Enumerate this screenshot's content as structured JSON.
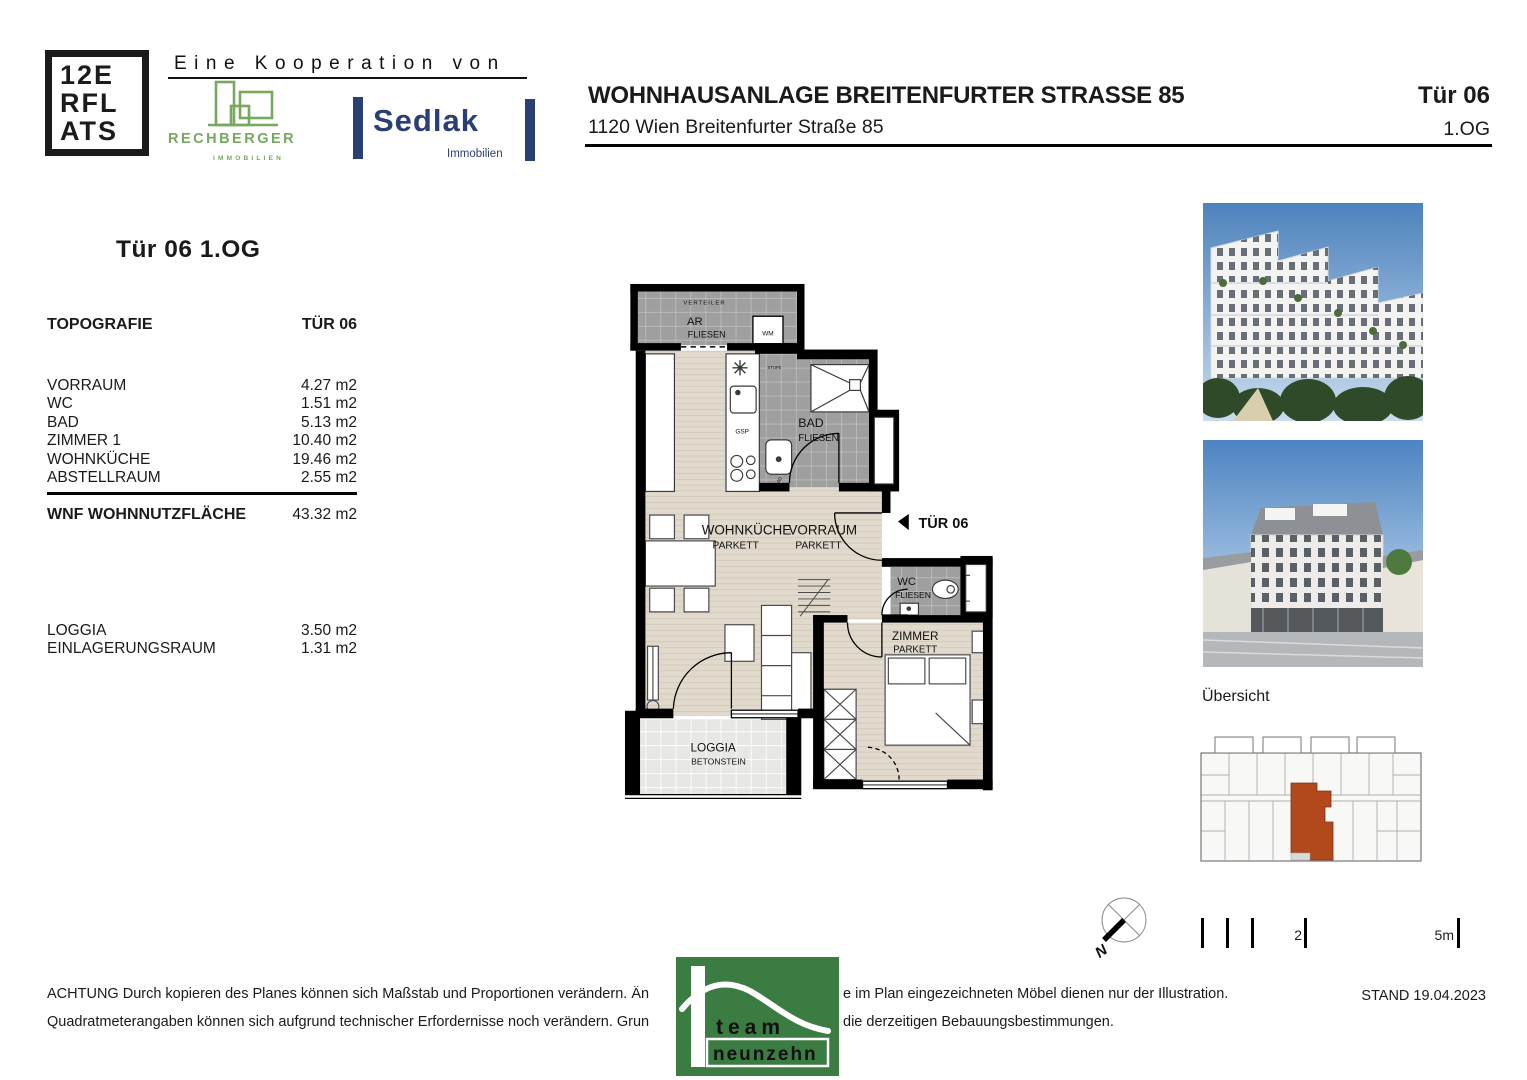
{
  "branding": {
    "flats_line1": "12E",
    "flats_line2": "RFL",
    "flats_line3": "ATS",
    "kooperation": "Eine Kooperation von",
    "rechberger": "RECHBERGER",
    "rechberger_sub": "IMMOBILIEN",
    "sedlak": "Sedlak",
    "sedlak_sub": "Immobilien"
  },
  "header": {
    "title": "WOHNHAUSANLAGE BREITENFURTER STRASSE 85",
    "subtitle": "1120 Wien  Breitenfurter Straße 85",
    "door": "Tür 06",
    "floor": "1.OG"
  },
  "info_panel": {
    "heading": "Tür 06  1.OG",
    "table_title": "TOPOGRAFIE",
    "table_col": "TÜR 06",
    "rooms": [
      {
        "label": "VORRAUM",
        "value": "4.27 m2"
      },
      {
        "label": "WC",
        "value": "1.51 m2"
      },
      {
        "label": "BAD",
        "value": "5.13 m2"
      },
      {
        "label": "ZIMMER 1",
        "value": "10.40 m2"
      },
      {
        "label": "WOHNKÜCHE",
        "value": "19.46 m2"
      },
      {
        "label": "ABSTELLRAUM",
        "value": "2.55 m2"
      }
    ],
    "total_label": "WNF WOHNNUTZFLÄCHE",
    "total_value": "43.32 m2",
    "extras": [
      {
        "label": "LOGGIA",
        "value": "3.50 m2"
      },
      {
        "label": "EINLAGERUNGSRAUM",
        "value": "1.31 m2"
      }
    ]
  },
  "floorplan": {
    "verteiler": "VERTEILER",
    "ar": "AR",
    "ar_floor": "FLIESEN",
    "wm": "WM",
    "stufe": "STUFE",
    "gsp": "GSP",
    "ad": "AD",
    "bad": "BAD",
    "bad_floor": "FLIESEN",
    "wohnkueche": "WOHNKÜCHE",
    "wohnkueche_floor": "PARKETT",
    "vorraum": "VORRAUM",
    "vorraum_floor": "PARKETT",
    "tuer_marker": "TÜR 06",
    "wc": "WC",
    "wc_floor": "FLIESEN",
    "zimmer": "ZIMMER",
    "zimmer_floor": "PARKETT",
    "loggia": "LOGGIA",
    "loggia_floor": "BETONSTEIN"
  },
  "sidebar": {
    "uebersicht_label": "Übersicht"
  },
  "scalebar": {
    "mid_label": "2",
    "end_label": "5m"
  },
  "compass": {
    "north": "N"
  },
  "footer": {
    "line1_left": "ACHTUNG Durch kopieren des Planes können sich Maßstab und Proportionen verändern. Än",
    "line1_right": "e im Plan eingezeichneten Möbel dienen nur der Illustration.",
    "line2_left": "Quadratmeterangaben können sich aufgrund technischer Erfordernisse noch verändern. Grun",
    "line2_right": "die derzeitigen Bebauungsbestimmungen.",
    "stand": "STAND 19.04.2023",
    "team_line1": "team",
    "team_line2": "neunzehn"
  },
  "colors": {
    "tile_gray": "#9f9f9f",
    "parkett": "#e0d9cc",
    "betonstein": "#e7e7e4",
    "unit_highlight": "#b1491d",
    "rechberger_green": "#76A85E",
    "sedlak_navy": "#2A3F72",
    "team_green": "#3A7C42"
  }
}
